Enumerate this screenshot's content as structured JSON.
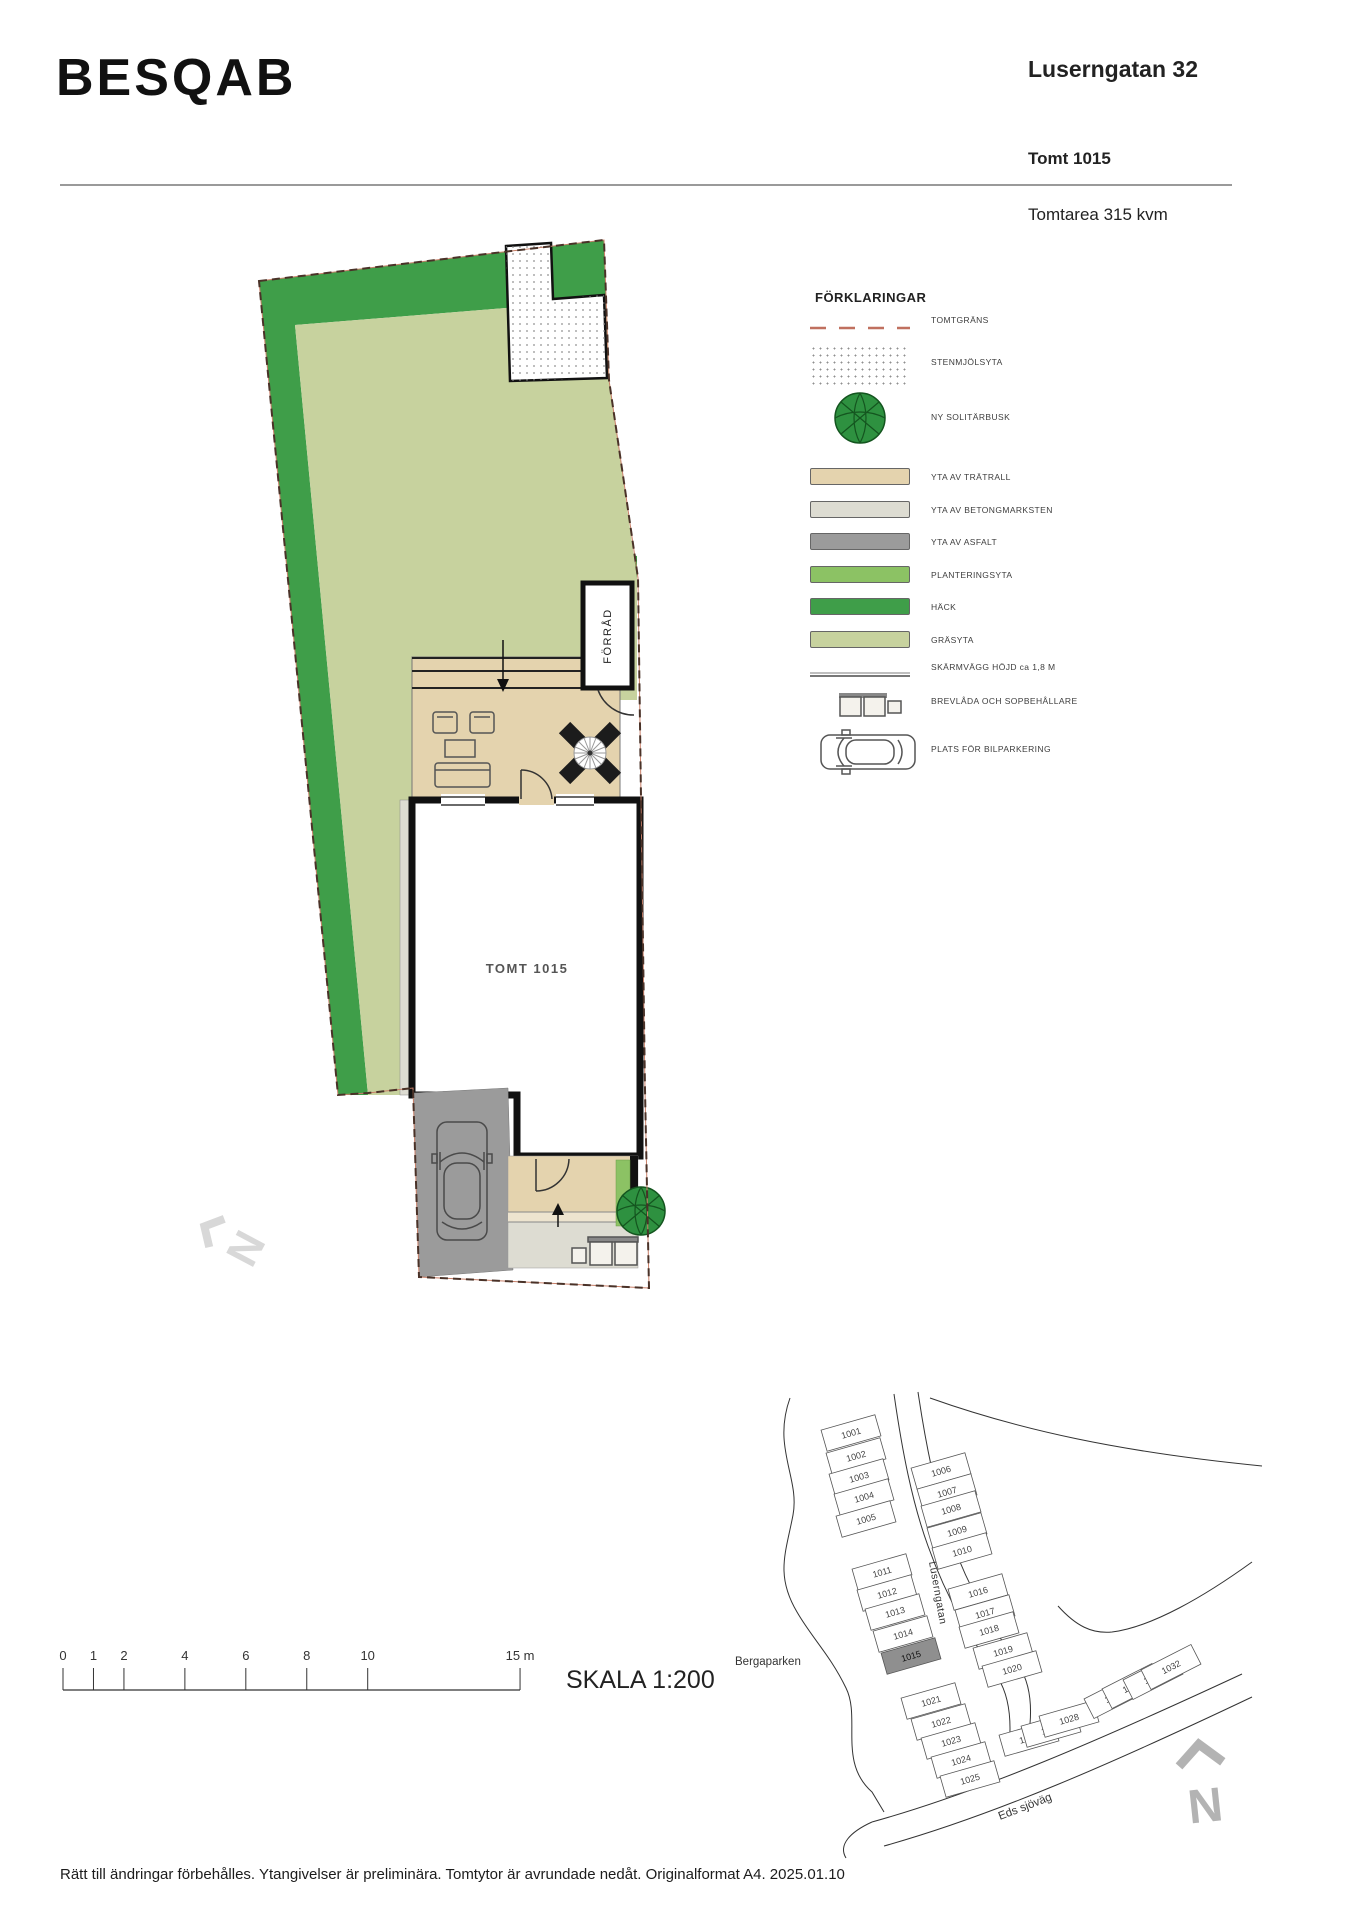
{
  "header": {
    "brand": "BESQAB",
    "address": "Luserngatan 32",
    "plot": "Tomt 1015",
    "area": "Tomtarea 315 kvm"
  },
  "plan": {
    "tomt_label": "TOMT 1015",
    "forrad_label": "FÖRRÅD"
  },
  "colors": {
    "hedge": "#3F9E49",
    "grass": "#C7D29E",
    "planting": "#8CC264",
    "wood_deck": "#E4D3AE",
    "concrete": "#DDDCD2",
    "asphalt": "#9B9B9B",
    "boundary": "#C0705F"
  },
  "legend": {
    "title": "FÖRKLARINGAR",
    "items": [
      {
        "id": "tomtgrans",
        "label": "TOMTGRÄNS",
        "type": "dashed-line",
        "color": "#C0705F"
      },
      {
        "id": "stenmjolsyta",
        "label": "STENMJÖLSYTA",
        "type": "dots",
        "color": "#8f8f8f"
      },
      {
        "id": "solitarbusk",
        "label": "NY SOLITÄRBUSK",
        "type": "bush",
        "color": "#2E9140"
      },
      {
        "id": "tratrall",
        "label": "YTA AV TRÄTRALL",
        "type": "swatch",
        "color": "#E4D3AE"
      },
      {
        "id": "betongmarksten",
        "label": "YTA AV BETONGMARKSTEN",
        "type": "swatch",
        "color": "#DDDCD2"
      },
      {
        "id": "asfalt",
        "label": "YTA AV ASFALT",
        "type": "swatch",
        "color": "#9B9B9B"
      },
      {
        "id": "planteringsyta",
        "label": "PLANTERINGSYTA",
        "type": "swatch",
        "color": "#8CC264"
      },
      {
        "id": "hack",
        "label": "HÄCK",
        "type": "swatch",
        "color": "#3F9E49"
      },
      {
        "id": "grasyta",
        "label": "GRÄSYTA",
        "type": "swatch",
        "color": "#C7D29E"
      },
      {
        "id": "skarmvagg",
        "label": "SKÄRMVÄGG HÖJD ca 1,8 M",
        "type": "wall-line",
        "color": "#888888"
      },
      {
        "id": "brevlada",
        "label": "BREVLÅDA OCH SOPBEHÅLLARE",
        "type": "mailbox",
        "color": "#555555"
      },
      {
        "id": "bilparkering",
        "label": "PLATS FÖR BILPARKERING",
        "type": "car",
        "color": "#555555"
      }
    ]
  },
  "scale_bar": {
    "ticks": [
      {
        "label": "0",
        "m": 0
      },
      {
        "label": "1",
        "m": 1
      },
      {
        "label": "2",
        "m": 2
      },
      {
        "label": "4",
        "m": 4
      },
      {
        "label": "6",
        "m": 6
      },
      {
        "label": "8",
        "m": 8
      },
      {
        "label": "10",
        "m": 10
      },
      {
        "label": "15 m",
        "m": 15
      }
    ],
    "label": "SKALA 1:200"
  },
  "map": {
    "park_label": "Bergaparken",
    "street_luserngatan": "Luserngatan",
    "street_eds": "Eds sjöväg",
    "north_label": "N",
    "highlighted_lot": "1015",
    "lots": [
      {
        "n": "1001",
        "x": 851,
        "y": 1433
      },
      {
        "n": "1002",
        "x": 856,
        "y": 1456
      },
      {
        "n": "1003",
        "x": 859,
        "y": 1477
      },
      {
        "n": "1004",
        "x": 864,
        "y": 1497
      },
      {
        "n": "1005",
        "x": 866,
        "y": 1519
      },
      {
        "n": "1006",
        "x": 941,
        "y": 1471
      },
      {
        "n": "1007",
        "x": 947,
        "y": 1492
      },
      {
        "n": "1008",
        "x": 951,
        "y": 1509
      },
      {
        "n": "1009",
        "x": 957,
        "y": 1531
      },
      {
        "n": "1010",
        "x": 962,
        "y": 1551
      },
      {
        "n": "1011",
        "x": 882,
        "y": 1572
      },
      {
        "n": "1012",
        "x": 887,
        "y": 1593
      },
      {
        "n": "1013",
        "x": 895,
        "y": 1612
      },
      {
        "n": "1014",
        "x": 903,
        "y": 1634
      },
      {
        "n": "1015",
        "x": 911,
        "y": 1656
      },
      {
        "n": "1016",
        "x": 978,
        "y": 1592
      },
      {
        "n": "1017",
        "x": 985,
        "y": 1613
      },
      {
        "n": "1018",
        "x": 989,
        "y": 1630
      },
      {
        "n": "1019",
        "x": 1003,
        "y": 1651
      },
      {
        "n": "1020",
        "x": 1012,
        "y": 1669
      },
      {
        "n": "1021",
        "x": 931,
        "y": 1701
      },
      {
        "n": "1022",
        "x": 941,
        "y": 1722
      },
      {
        "n": "1023",
        "x": 951,
        "y": 1741
      },
      {
        "n": "1024",
        "x": 961,
        "y": 1760
      },
      {
        "n": "1025",
        "x": 970,
        "y": 1779
      },
      {
        "n": "1026",
        "x": 1029,
        "y": 1738
      },
      {
        "n": "1027",
        "x": 1051,
        "y": 1729
      },
      {
        "n": "1028",
        "x": 1069,
        "y": 1719
      },
      {
        "n": "1029",
        "x": 1114,
        "y": 1696
      },
      {
        "n": "1030",
        "x": 1132,
        "y": 1686
      },
      {
        "n": "1031",
        "x": 1153,
        "y": 1677
      },
      {
        "n": "1032",
        "x": 1171,
        "y": 1667
      }
    ]
  },
  "footer": {
    "disclaimer": "Rätt till ändringar förbehålles. Ytangivelser är preliminära. Tomtytor är avrundade nedåt. Originalformat A4. 2025.01.10"
  }
}
